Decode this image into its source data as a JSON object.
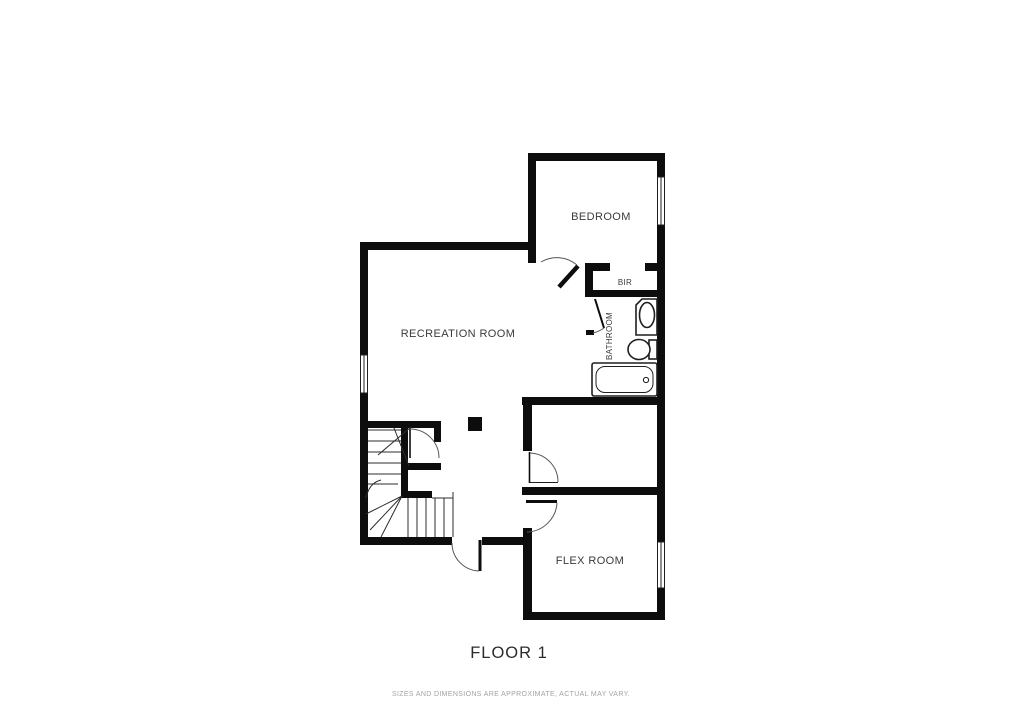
{
  "rooms": [
    {
      "name": "BEDROOM"
    },
    {
      "name": "BIR"
    },
    {
      "name": "BATHROOM"
    },
    {
      "name": "RECREATION ROOM"
    },
    {
      "name": "FLEX ROOM"
    }
  ],
  "footer": {
    "title": "FLOOR 1",
    "disclaimer": "SIZES AND DIMENSIONS ARE APPROXIMATE, ACTUAL MAY VARY."
  },
  "colors": {
    "background": "#ffffff",
    "wall": "#0d0d0d",
    "label": "#3a3a3a",
    "disclaimer_text": "#a3a3a3"
  }
}
